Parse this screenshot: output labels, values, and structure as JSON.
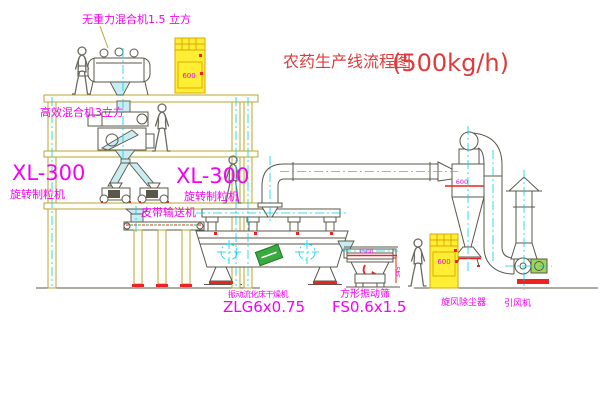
{
  "title": {
    "name": "农药生产线流程图",
    "capacity": "(500kg/h)"
  },
  "labels": {
    "gravity_mixer": "无重力混合机1.5 立方",
    "high_efficiency_mixer": "高效混合机3立方",
    "granulator_left": {
      "model": "XL-300",
      "name": "旋转制粒机"
    },
    "granulator_center": {
      "model": "XL-300",
      "name": "旋转制粒机"
    },
    "belt_conveyor": "皮带输送机",
    "dryer": {
      "name": "振动流化床干燥机",
      "model": "ZLG6x0.75"
    },
    "sieve": {
      "name": "方形振动筛",
      "model": "FS0.6x1.5"
    },
    "cyclone": "旋风除尘器",
    "induced_draft_fan": "引风机"
  },
  "dimensions": {
    "cyclone_width": "600",
    "top_elevator": "600",
    "bottom_elevator": "600",
    "sieve_length": "1500",
    "sieve_height": "345"
  },
  "colors": {
    "frame": "#b9a53b",
    "equip": "#5a574a",
    "person": "#6b6b60",
    "chute": "#c9ecf2",
    "centerline": "#00d4e4",
    "magenta": "#f400f4",
    "title-red": "#e13a3a",
    "accent-red": "#ee2222",
    "accent-green": "#3aa93f",
    "cabinet-fill": "#ffee33",
    "cabinet-edge": "#d9a800"
  }
}
